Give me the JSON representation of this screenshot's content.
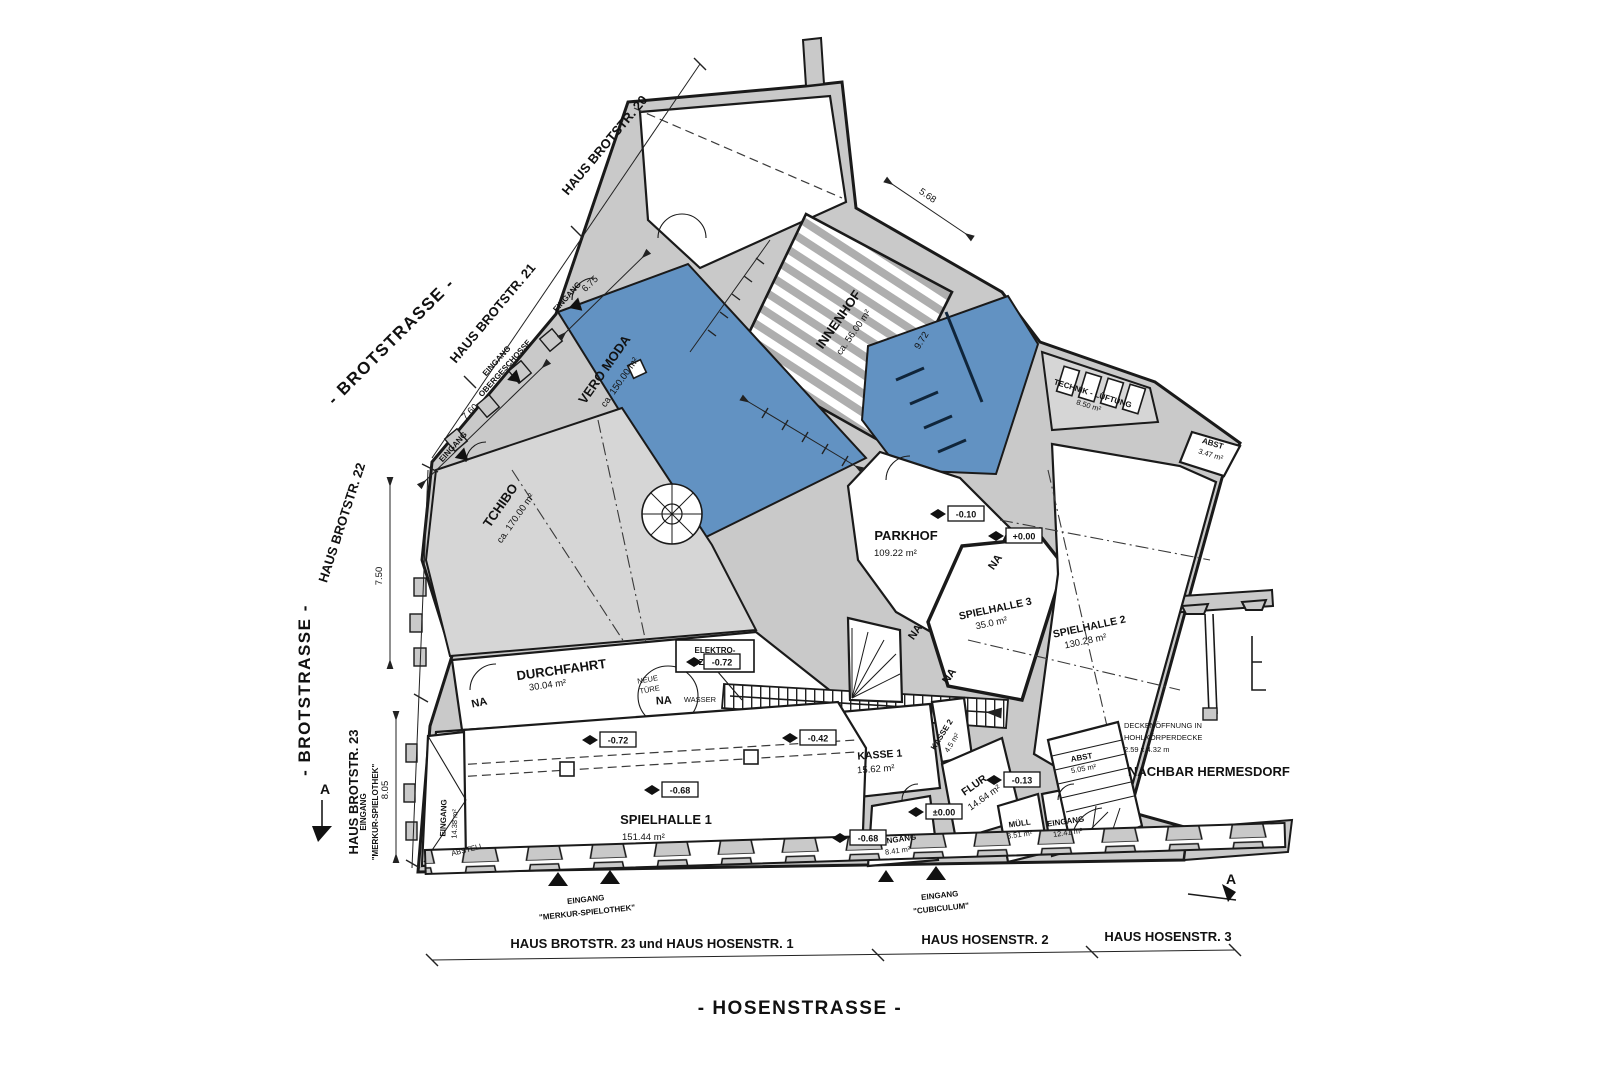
{
  "streets": {
    "brotstrasse_diagonal": "- BROTSTRASSE -",
    "brotstrasse_vertical": "- BROTSTRASSE -",
    "hosenstrasse": "- HOSENSTRASSE -"
  },
  "houses_top": {
    "h20": "HAUS BROTSTR. 20",
    "h21": "HAUS BROTSTR. 21",
    "h22": "HAUS BROTSTR. 22",
    "h23": "HAUS BROTSTR. 23"
  },
  "houses_bottom": {
    "b1": "HAUS BROTSTR. 23 und HAUS HOSENSTR. 1",
    "b2": "HAUS HOSENSTR. 2",
    "b3": "HAUS HOSENSTR. 3"
  },
  "rooms": {
    "vero_moda": {
      "name": "VERO MODA",
      "area": "ca. 150.00 m²"
    },
    "innenhof": {
      "name": "INNENHOF",
      "area": "ca. 56.00 m²"
    },
    "tchibo": {
      "name": "TCHIBO",
      "area": "ca. 170.00 m²"
    },
    "durchfahrt": {
      "name": "DURCHFAHRT",
      "area": "30.04 m²"
    },
    "parkhof": {
      "name": "PARKHOF",
      "area": "109.22 m²"
    },
    "spielhalle1": {
      "name": "SPIELHALLE 1",
      "area": "151.44 m²"
    },
    "spielhalle2": {
      "name": "SPIELHALLE 2",
      "area": "130.28 m²"
    },
    "spielhalle3": {
      "name": "SPIELHALLE 3",
      "area": "35.0 m²"
    },
    "kasse1": {
      "name": "KASSE 1",
      "area": "15.62 m²"
    },
    "kasse2": {
      "name": "KASSE 2",
      "area": "4.5 m²"
    },
    "flur": {
      "name": "FLUR",
      "area": "14.64 m²"
    },
    "muell": {
      "name": "MÜLL",
      "area": "3.51 m²"
    },
    "eingang_links": {
      "name": "EINGANG",
      "area": "14.38 m²"
    },
    "eingang_mitte": {
      "name": "EINGANG",
      "area": "8.41 m²"
    },
    "eingang_rechts": {
      "name": "EINGANG",
      "area": "12.41 m²"
    },
    "technik": {
      "name": "TECHNIK - LÜFTUNG",
      "area": "8.50 m²"
    },
    "abst1": {
      "name": "ABST",
      "area": "3.47 m²"
    },
    "abst2": {
      "name": "ABST",
      "area": "5.05 m²"
    },
    "abstell": {
      "name": "ABSTELL"
    }
  },
  "annotations": {
    "elektro_line1": "ELEKTRO-",
    "elektro_line2": "ZÄHLER",
    "neue_tuere_line1": "NEUE",
    "neue_tuere_line2": "TÜRE",
    "wasser": "WASSER",
    "nachbar": "NACHBAR HERMESDORF",
    "decken_line1": "DECKENÖFFNUNG IN",
    "decken_line2": "HOHLKÖRPERDECKE",
    "decken_line3": "2.59 x 4.32 m",
    "na": "NA",
    "section_marker": "A"
  },
  "entrances": {
    "plain": "EINGANG",
    "oberg_line1": "EINGANG",
    "oberg_line2": "OBERGESCHOSSE",
    "merkur_line1": "EINGANG",
    "merkur_line2": "\"MERKUR-SPIELOTHEK\"",
    "cubiculum_line1": "EINGANG",
    "cubiculum_line2": "\"CUBICULUM\""
  },
  "levels": {
    "m072": "-0.72",
    "m042": "-0.42",
    "m068": "-0.68",
    "m010": "-0.10",
    "p000": "+0.00",
    "pm000": "±0.00",
    "m013": "-0.13"
  },
  "dimensions": {
    "d675": "6.75",
    "d760": "7.60",
    "d750": "7.50",
    "d805": "8.05",
    "d568": "5.68",
    "d972": "9.72"
  },
  "colors": {
    "blue_room": "#6292c2",
    "wall_gray": "#c9c9c9",
    "room_gray": "#d6d6d6",
    "hatch_gray": "#aeaeae",
    "line": "#1a1a1a"
  }
}
